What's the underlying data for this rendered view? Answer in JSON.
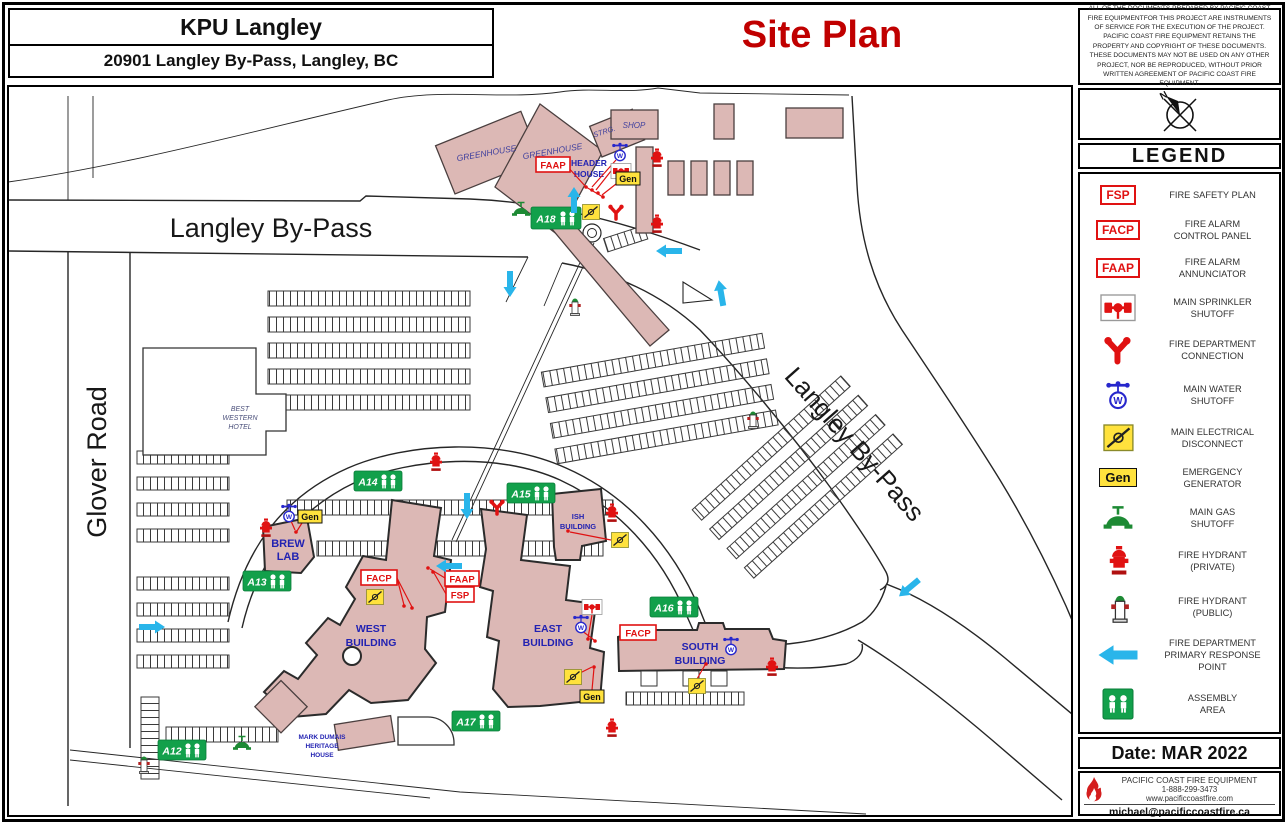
{
  "header": {
    "project": "KPU Langley",
    "address": "20901 Langley By-Pass, Langley, BC",
    "sheet_title": "Site Plan"
  },
  "disclaimer": "ALL OF THE DOCUMENTS PREPARED BY PACIFIC COAST FIRE EQUIPMENTFOR THIS PROJECT ARE INSTRUMENTS OF SERVICE FOR THE EXECUTION OF THE PROJECT. PACIFIC COAST FIRE EQUIPMENT RETAINS THE PROPERTY AND COPYRIGHT OF THESE DOCUMENTS. THESE DOCUMENTS MAY NOT BE USED ON ANY OTHER PROJECT, NOR BE REPRODUCED, WITHOUT PRIOR WRITTEN AGREEMENT OF PACIFIC COAST FIRE EQUIPMENT.",
  "compass": {
    "north": "N"
  },
  "legend": {
    "title": "LEGEND",
    "items": [
      {
        "icon": "fsp-tag",
        "symbol": "FSP",
        "label": "FIRE SAFETY PLAN"
      },
      {
        "icon": "facp-tag",
        "symbol": "FACP",
        "label": "FIRE ALARM\nCONTROL PANEL"
      },
      {
        "icon": "faap-tag",
        "symbol": "FAAP",
        "label": "FIRE ALARM\nANNUNCIATOR"
      },
      {
        "icon": "sprinkler-shutoff-icon",
        "symbol": "",
        "label": "MAIN SPRINKLER\nSHUTOFF"
      },
      {
        "icon": "fire-department-connection-icon",
        "symbol": "",
        "label": "FIRE DEPARTMENT\nCONNECTION"
      },
      {
        "icon": "water-shutoff-icon",
        "symbol": "",
        "label": "MAIN WATER\nSHUTOFF"
      },
      {
        "icon": "electrical-disconnect-icon",
        "symbol": "",
        "label": "MAIN ELECTRICAL\nDISCONNECT"
      },
      {
        "icon": "generator-tag",
        "symbol": "Gen",
        "label": "EMERGENCY\nGENERATOR"
      },
      {
        "icon": "gas-shutoff-icon",
        "symbol": "",
        "label": "MAIN GAS\nSHUTOFF"
      },
      {
        "icon": "hydrant-private-icon",
        "symbol": "",
        "label": "FIRE HYDRANT\n(PRIVATE)"
      },
      {
        "icon": "hydrant-public-icon",
        "symbol": "",
        "label": "FIRE HYDRANT\n(PUBLIC)"
      },
      {
        "icon": "response-arrow-icon",
        "symbol": "",
        "label": "FIRE DEPARTMENT\nPRIMARY RESPONSE\nPOINT"
      },
      {
        "icon": "assembly-area-icon",
        "symbol": "",
        "label": "ASSEMBLY\nAREA"
      }
    ]
  },
  "titleblock": {
    "date": "Date: MAR 2022",
    "company": "PACIFIC COAST FIRE EQUIPMENT",
    "phone": "1-888-299-3473",
    "website": "www.pacificcoastfire.com",
    "email": "michael@pacificcoastfire.ca"
  },
  "map": {
    "roads": {
      "glover": "Glover Road",
      "bypass_top": "Langley By-Pass",
      "bypass_diag": "Langley By-Pass"
    },
    "buildings": {
      "greenhouse_west": "GREENHOUSE",
      "greenhouse_east": "GREENHOUSE",
      "strg": "STRG.",
      "shop": "SHOP",
      "header_house": [
        "HEADER",
        "HOUSE"
      ],
      "hotel": [
        "BEST",
        "WESTERN",
        "HOTEL"
      ],
      "brew_lab": [
        "BREW",
        "LAB"
      ],
      "west": [
        "WEST",
        "BUILDING"
      ],
      "east": [
        "EAST",
        "BUILDING"
      ],
      "south": [
        "SOUTH",
        "BUILDING"
      ],
      "ish": [
        "ISH",
        "BUILDING"
      ],
      "heritage": [
        "MARK DUMAIS",
        "HERITAGE",
        "HOUSE"
      ]
    },
    "assembly_points": [
      "A12",
      "A13",
      "A14",
      "A15",
      "A16",
      "A17",
      "A18"
    ],
    "tags": {
      "facp": "FACP",
      "faap": "FAAP",
      "fsp": "FSP",
      "gen": "Gen"
    },
    "icons": {
      "water_letter": "W"
    }
  },
  "colors": {
    "building_fill": "#dcb8b5",
    "assembly_green": "#12a04b",
    "response_blue": "#29b5ea",
    "alarm_red": "#e01212",
    "title_red": "#c00000",
    "electrical_yellow": "#ffe23d",
    "water_blue": "#2727cc",
    "gas_green": "#1d8a34",
    "label_navy": "#2222b2"
  }
}
